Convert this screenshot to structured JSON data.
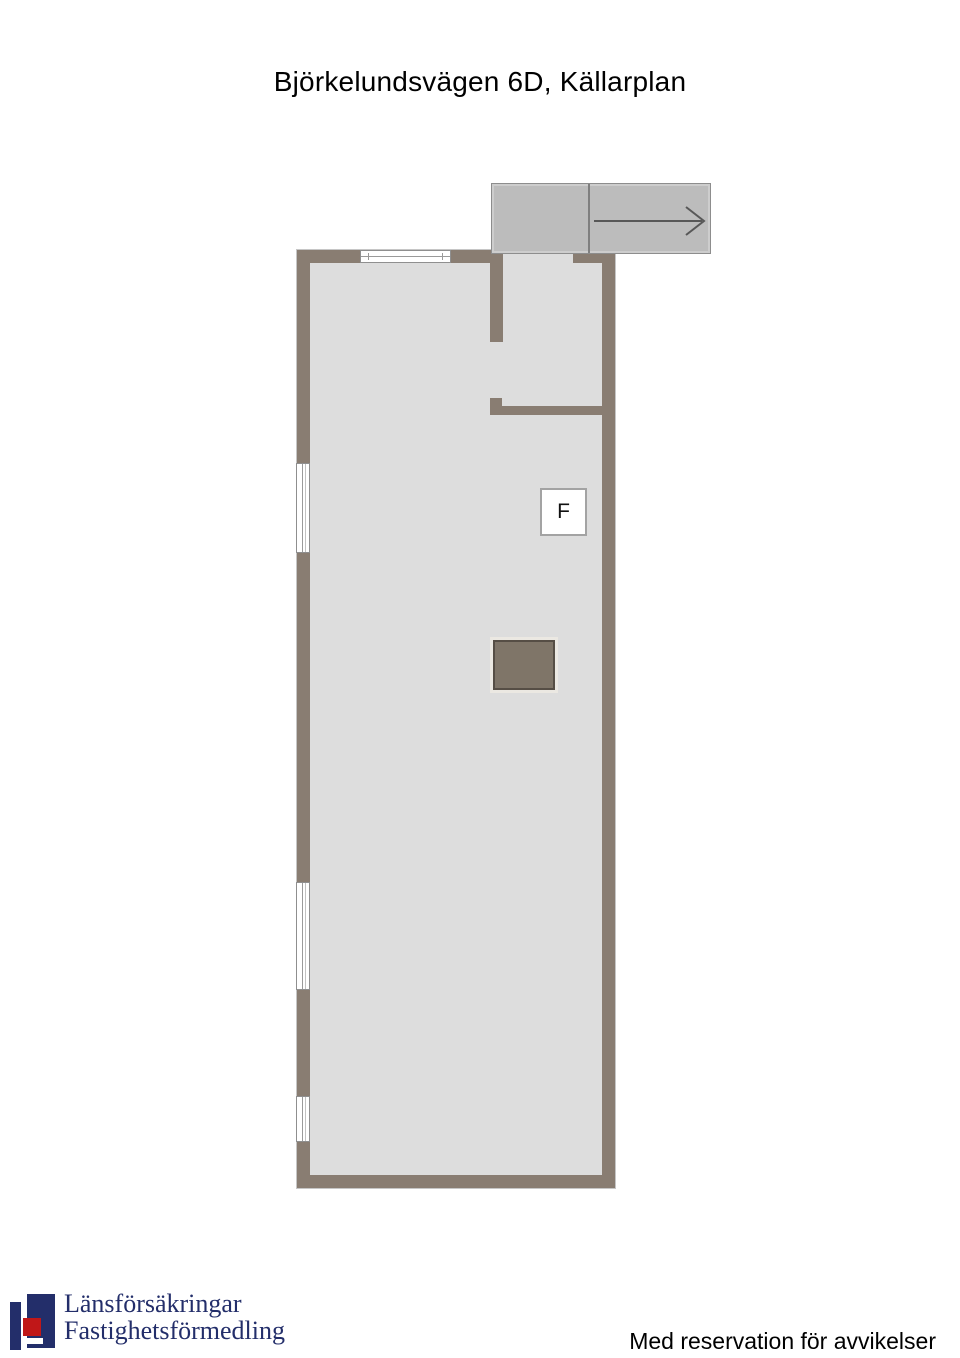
{
  "title": "Björkelundsvägen 6D, Källarplan",
  "plan": {
    "name": "basement-floor-plan",
    "f_marker_label": "F",
    "stair_arrow_direction": "right"
  },
  "colors": {
    "wall": "#897d72",
    "floor": "#dddddd",
    "stair_fill": "#bcbcbc",
    "shaft_fill": "#7f7568",
    "shaft_border": "#564e45",
    "brand_navy": "#232e6a",
    "brand_red": "#c01718"
  },
  "footer": {
    "brand_line1": "Länsförsäkringar",
    "brand_line2": "Fastighetsförmedling",
    "disclaimer": "Med reservation för avvikelser"
  }
}
